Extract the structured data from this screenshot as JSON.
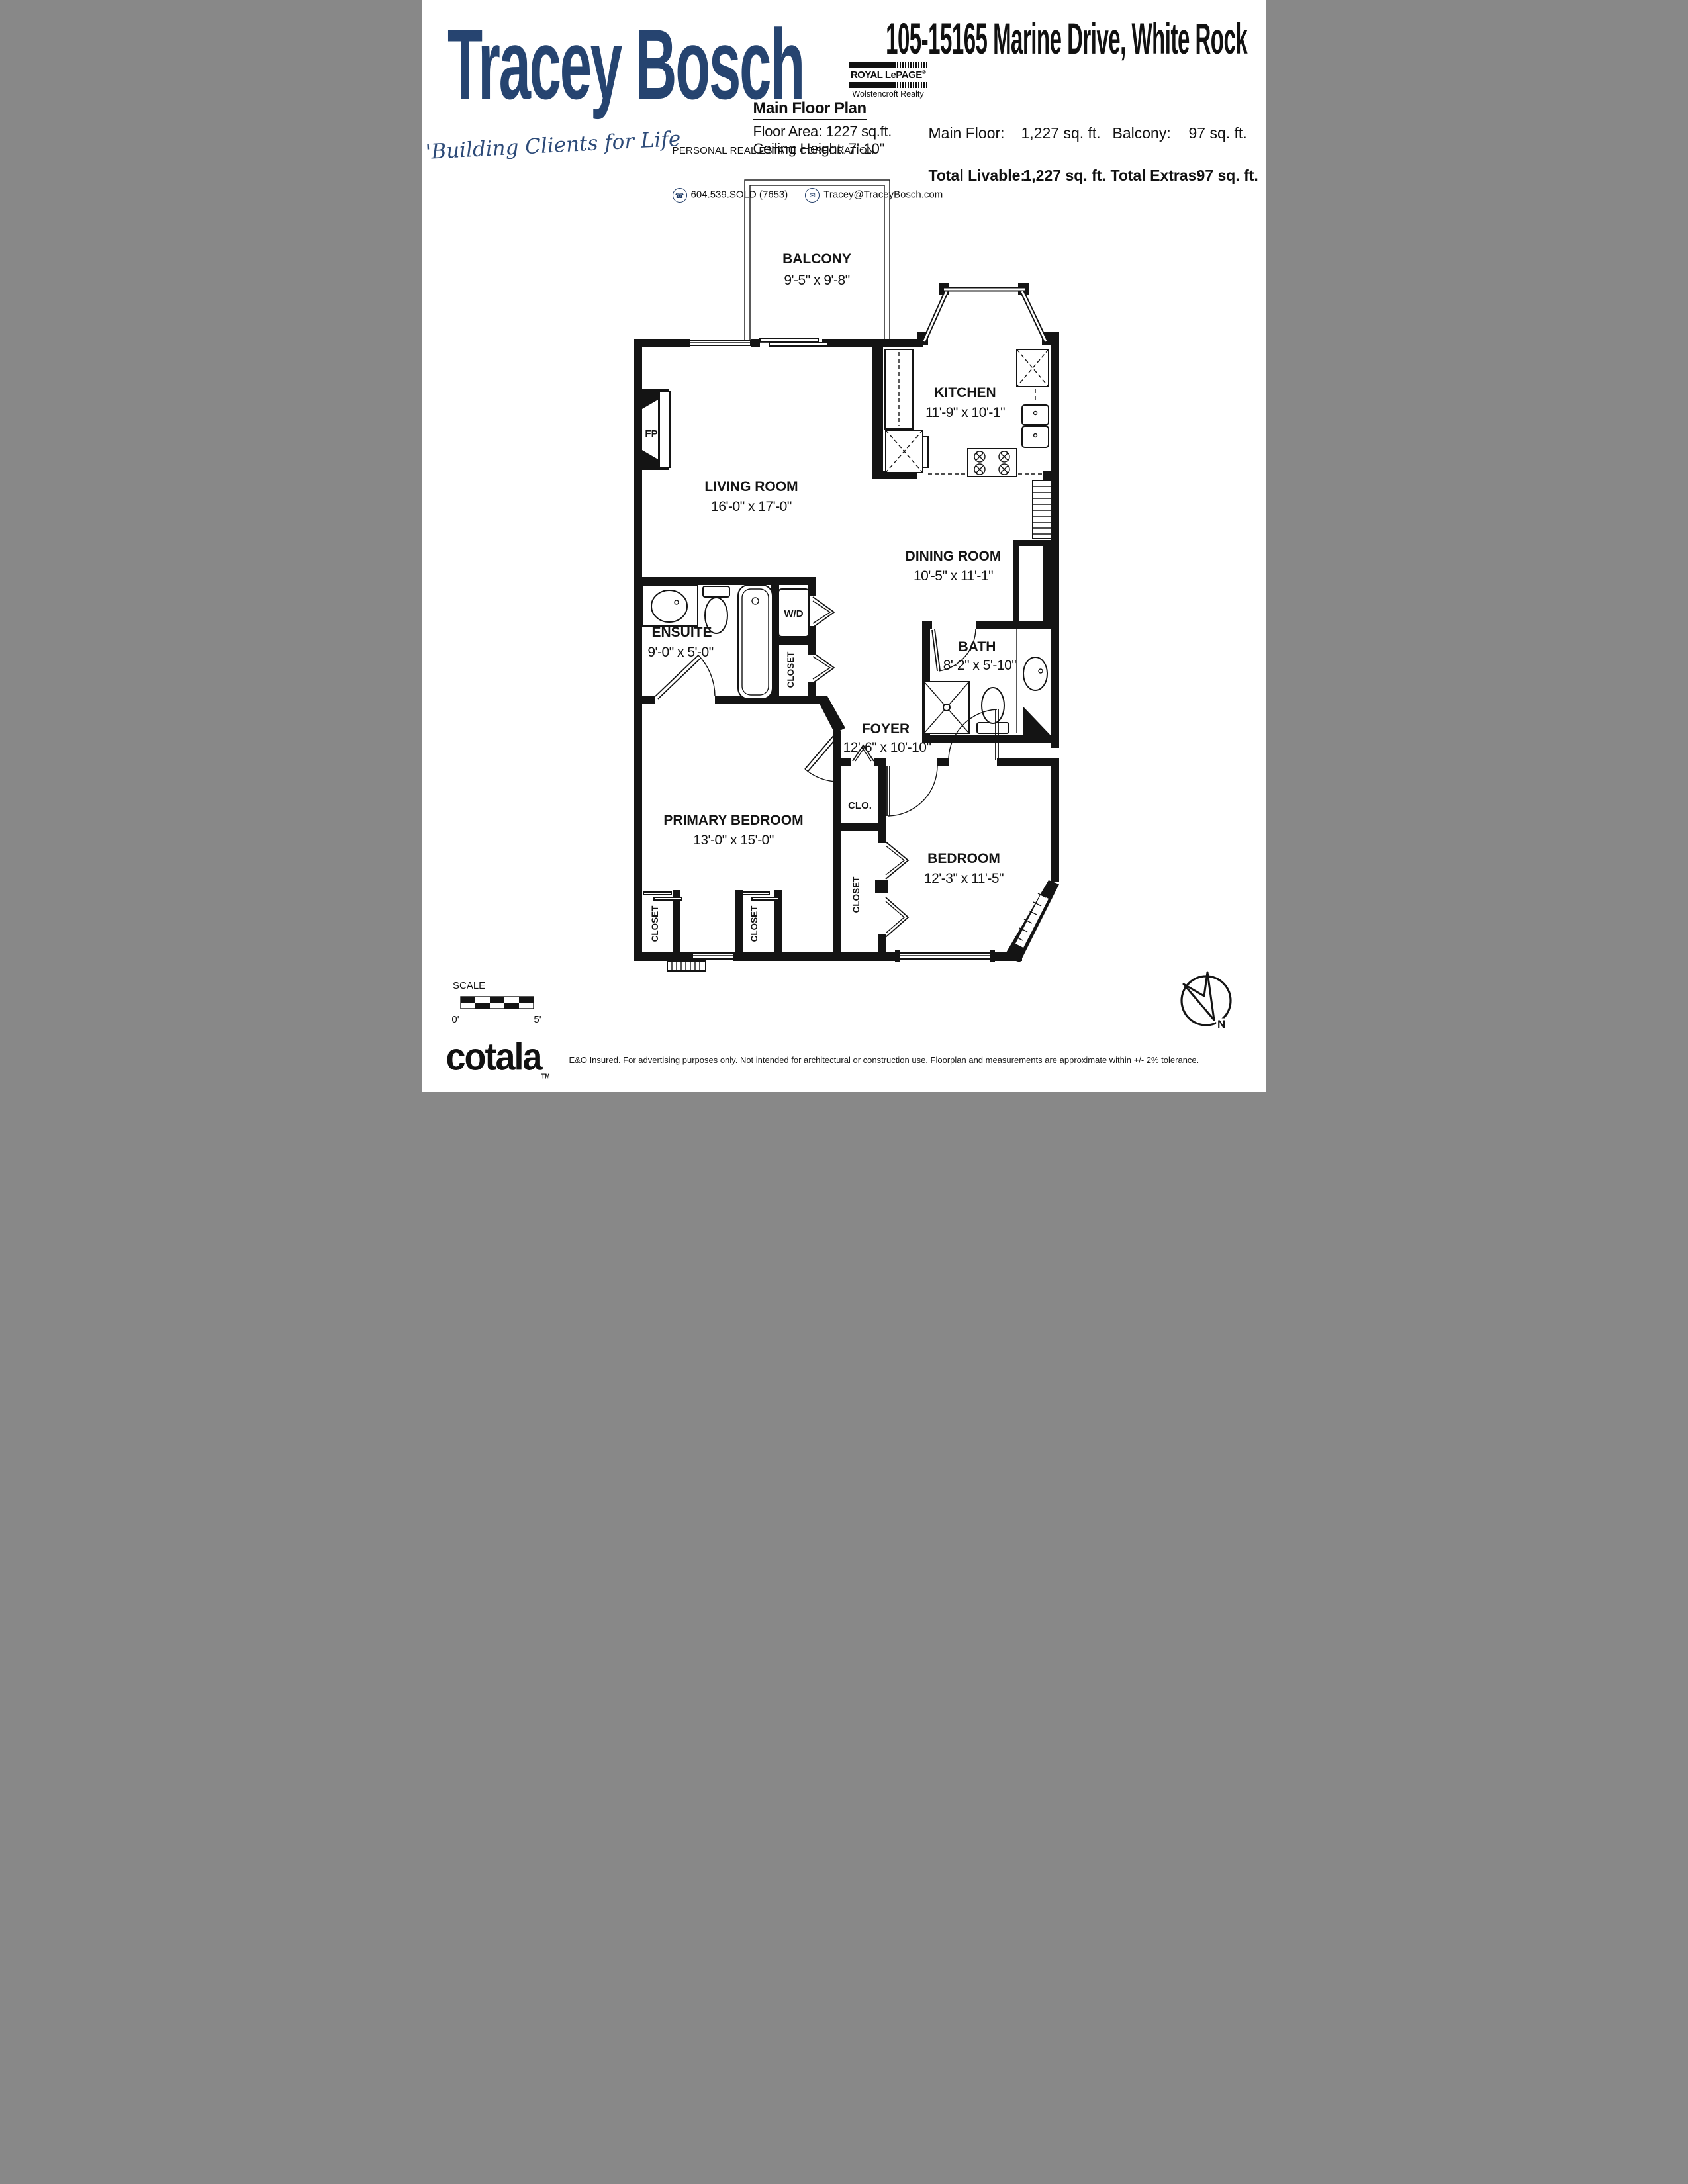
{
  "header": {
    "agent_name": "Tracey Bosch",
    "tagline": "'Building Clients for Life",
    "brand": "ROYAL LePAGE",
    "brand_reg": "®",
    "brand_office": "Wolstencroft Realty",
    "corporation": "PERSONAL REAL ESTATE CORPORATION",
    "phone": "604.539.SOLD (7653)",
    "email": "Tracey@TraceyBosch.com",
    "address": "105-15165 Marine Drive, White Rock",
    "stats": {
      "main_floor_label": "Main Floor:",
      "main_floor_value": "1,227 sq. ft.",
      "balcony_label": "Balcony:",
      "balcony_value": "97 sq. ft.",
      "total_livable_label": "Total Livable:",
      "total_livable_value": "1,227 sq. ft.",
      "total_extras_label": "Total Extras:",
      "total_extras_value": "97 sq. ft."
    }
  },
  "plan": {
    "title": "Main Floor Plan",
    "floor_area": "Floor Area: 1227 sq.ft.",
    "ceiling_height": "Ceiling Height: 7'-10\"",
    "rooms": {
      "balcony": {
        "name": "BALCONY",
        "dims": "9'-5\" x 9'-8\""
      },
      "kitchen": {
        "name": "KITCHEN",
        "dims": "11'-9\" x 10'-1\""
      },
      "living": {
        "name": "LIVING ROOM",
        "dims": "16'-0\" x 17'-0\""
      },
      "dining": {
        "name": "DINING ROOM",
        "dims": "10'-5\" x 11'-1\""
      },
      "ensuite": {
        "name": "ENSUITE",
        "dims": "9'-0\" x 5'-0\""
      },
      "bath": {
        "name": "BATH",
        "dims": "8'-2\" x 5'-10\""
      },
      "foyer": {
        "name": "FOYER",
        "dims": "12'-6\" x 10'-10\""
      },
      "primary": {
        "name": "PRIMARY BEDROOM",
        "dims": "13'-0\" x 15'-0\""
      },
      "bedroom": {
        "name": "BEDROOM",
        "dims": "12'-3\" x 11'-5\""
      }
    },
    "labels": {
      "wd": "W/D",
      "fp": "FP",
      "clo": "CLO.",
      "closet": "CLOSET"
    }
  },
  "scale_bar": {
    "label": "SCALE",
    "start": "0'",
    "end": "5'"
  },
  "compass": {
    "north": "N"
  },
  "footer": {
    "brand": "cotala",
    "tm": "TM",
    "disclaimer": "E&O Insured. For advertising purposes only. Not intended for architectural or construction use. Floorplan and measurements are approximate within +/- 2% tolerance."
  },
  "colors": {
    "navy": "#264470",
    "ink": "#141414"
  }
}
